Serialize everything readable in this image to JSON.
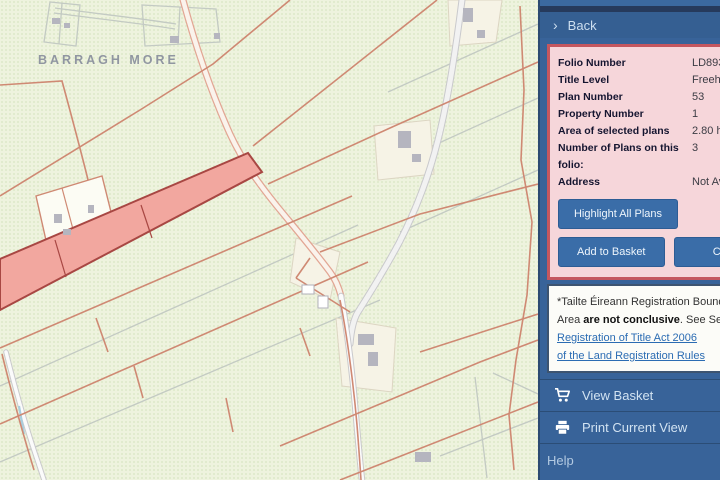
{
  "map": {
    "townland_label": "BARRAGH MORE"
  },
  "sidebar": {
    "back_label": "Back",
    "folio_panel": {
      "rows": [
        {
          "label": "Folio Number",
          "value": "LD8936"
        },
        {
          "label": "Title Level",
          "value": "Freehold"
        },
        {
          "label": "Plan Number",
          "value": "53"
        },
        {
          "label": "Property Number",
          "value": "1"
        },
        {
          "label": "Area of selected plans",
          "value": "2.80 hectares"
        },
        {
          "label": "Number of Plans on this folio:",
          "value": "3"
        },
        {
          "label": "Address",
          "value": "Not Available"
        }
      ],
      "buttons": {
        "highlight_all_plans": "Highlight All Plans",
        "add_to_basket": "Add to Basket",
        "close": "Close"
      }
    },
    "disclaimer": {
      "line1": "*Tailte Éireann Registration Boundaries and",
      "line2_pre": "Area ",
      "line2_bold": "are not conclusive",
      "line2_post": ". See Section 85 of the",
      "link1": "Registration of Title Act 2006",
      "link2": "of the Land Registration Rules"
    },
    "menu": [
      {
        "label": "View Basket"
      },
      {
        "label": "Print Current View"
      },
      {
        "label": "Help"
      }
    ]
  },
  "colors": {
    "sidebar_blue": "#386399",
    "panel_pink": "#f6d6da",
    "panel_border_red": "#c4575f",
    "highlight_parcel_fill": "#f2a79f",
    "highlight_parcel_stroke": "#a84743",
    "registry_line": "#cf8973",
    "map_background": "#eef3de",
    "link_blue": "#2b6cb3"
  }
}
